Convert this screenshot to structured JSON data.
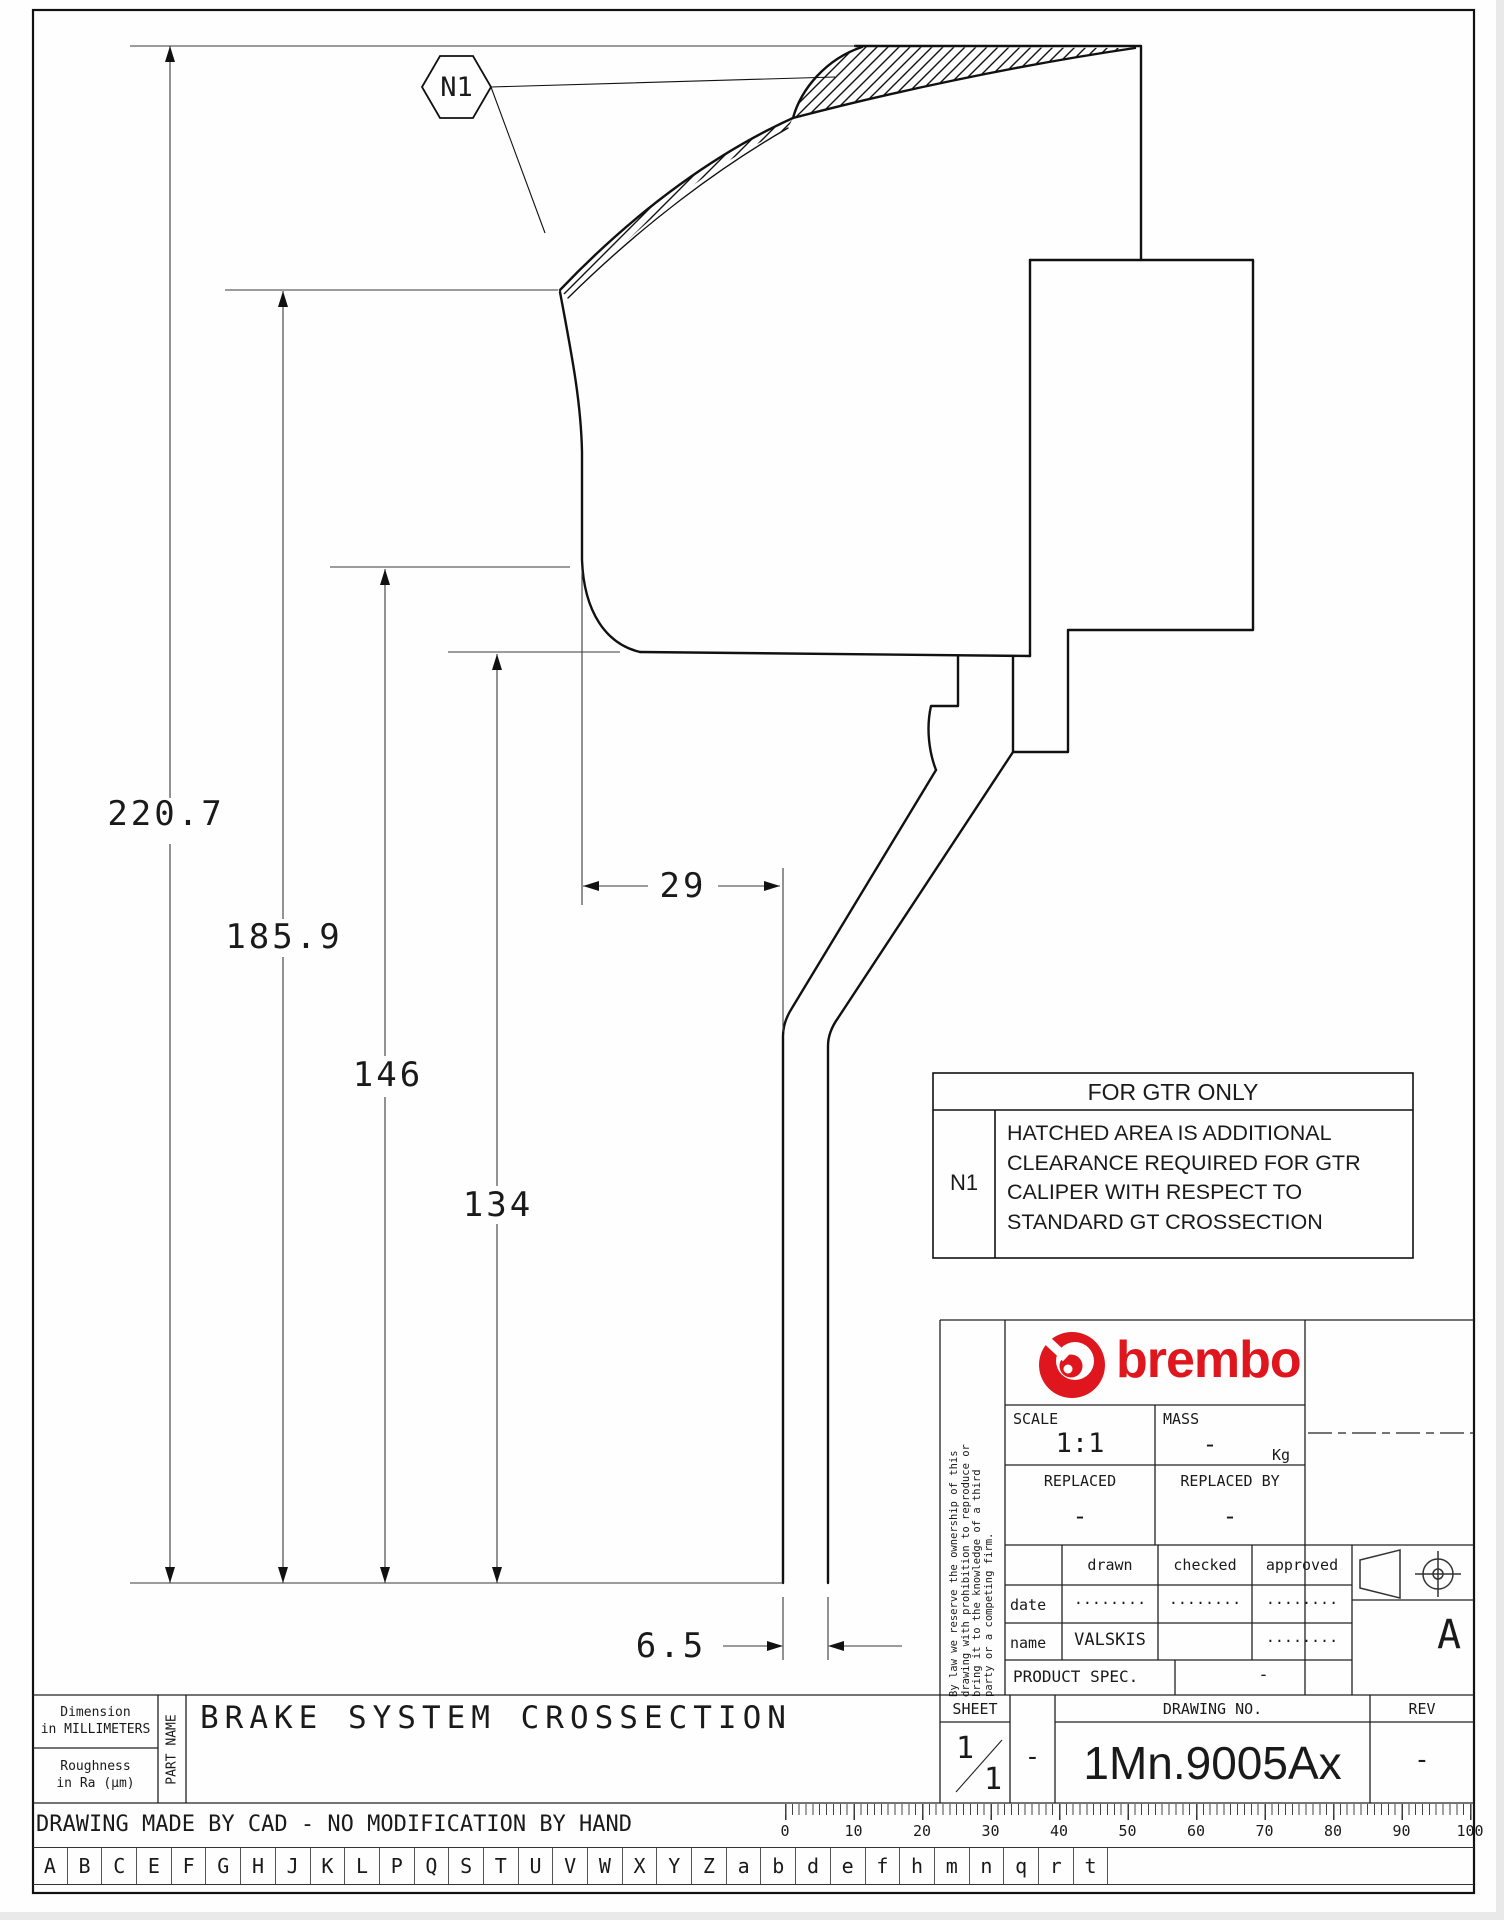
{
  "drawing": {
    "callout": "N1",
    "dim_height_1": "220.7",
    "dim_height_2": "185.9",
    "dim_height_3": "146",
    "dim_height_4": "134",
    "dim_width": "29",
    "dim_thickness": "6.5"
  },
  "gtr_note": {
    "title": "FOR GTR ONLY",
    "ref": "N1",
    "text": "HATCHED AREA IS ADDITIONAL\nCLEARANCE REQUIRED FOR GTR\nCALIPER WITH RESPECT TO\nSTANDARD GT CROSSECTION"
  },
  "title_block": {
    "brand": "brembo",
    "disclaimer": "By law we reserve the ownership of this\ndrawing with prohibition to reproduce or\nbring it to the knowledge of a third\nparty or a competing firm.",
    "scale_label": "SCALE",
    "scale_value": "1:1",
    "mass_label": "MASS",
    "mass_value": "-",
    "mass_unit": "Kg",
    "replaced_label": "REPLACED",
    "replaced_value": "-",
    "replaced_by_label": "REPLACED BY",
    "replaced_by_value": "-",
    "col_drawn": "drawn",
    "col_checked": "checked",
    "col_approved": "approved",
    "date_label": "date",
    "date_drawn": "........",
    "date_checked": "........",
    "date_approved": "........",
    "name_label": "name",
    "name_drawn": "VALSKIS",
    "name_checked": "",
    "name_approved": "........",
    "product_spec_label": "PRODUCT SPEC.",
    "product_spec_value": "-",
    "format_letter": "A",
    "sheet_label": "SHEET",
    "sheet_current": "1",
    "sheet_total": "1",
    "sheet_dash": "-",
    "drawing_no_label": "DRAWING NO.",
    "drawing_no": "1Mn.9005Ax",
    "rev_label": "REV",
    "rev_value": "-"
  },
  "footer": {
    "dimension_note": "Dimension\nin MILLIMETERS",
    "roughness_note": "Roughness\nin Ra (µm)",
    "part_name_label": "PART NAME",
    "part_name": "BRAKE SYSTEM CROSSECTION",
    "cad_note": "DRAWING MADE BY CAD - NO MODIFICATION BY HAND"
  },
  "ruler_labels": [
    "0",
    "10",
    "20",
    "30",
    "40",
    "50",
    "60",
    "70",
    "80",
    "90",
    "100"
  ],
  "font_letters": [
    "A",
    "B",
    "C",
    "E",
    "F",
    "G",
    "H",
    "J",
    "K",
    "L",
    "P",
    "Q",
    "S",
    "T",
    "U",
    "V",
    "W",
    "X",
    "Y",
    "Z",
    "a",
    "b",
    "d",
    "e",
    "f",
    "h",
    "m",
    "n",
    "q",
    "r",
    "t"
  ],
  "colors": {
    "brembo_red": "#e0161f",
    "line_color": "#1a1a1a",
    "paper": "#fefefe"
  }
}
